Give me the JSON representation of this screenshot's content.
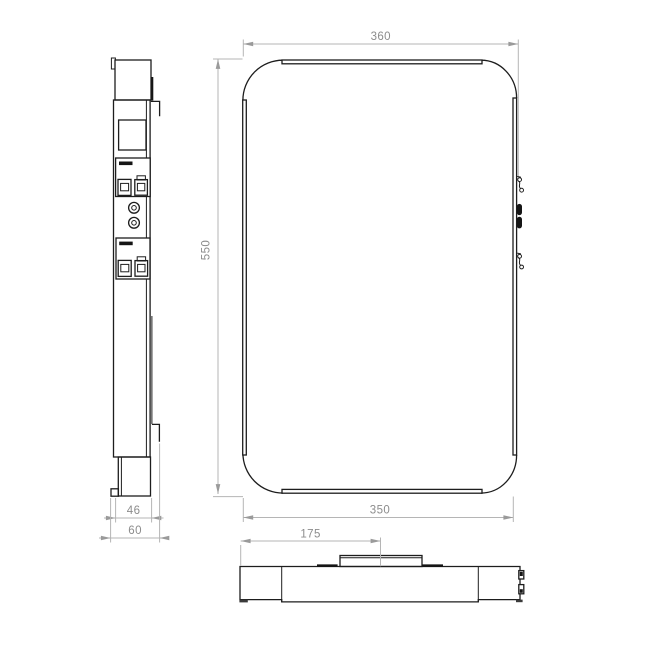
{
  "dimensions": {
    "front_width_top": "360",
    "front_height": "550",
    "front_width_bottom": "350",
    "bottom_bracket_offset": "175",
    "side_depth_inner": "46",
    "side_depth_overall": "60"
  },
  "colors": {
    "background": "#ffffff",
    "outline": "#1d1d1d",
    "dimension_lines": "#b5b5b5",
    "dimension_text": "#8c8c8c"
  }
}
